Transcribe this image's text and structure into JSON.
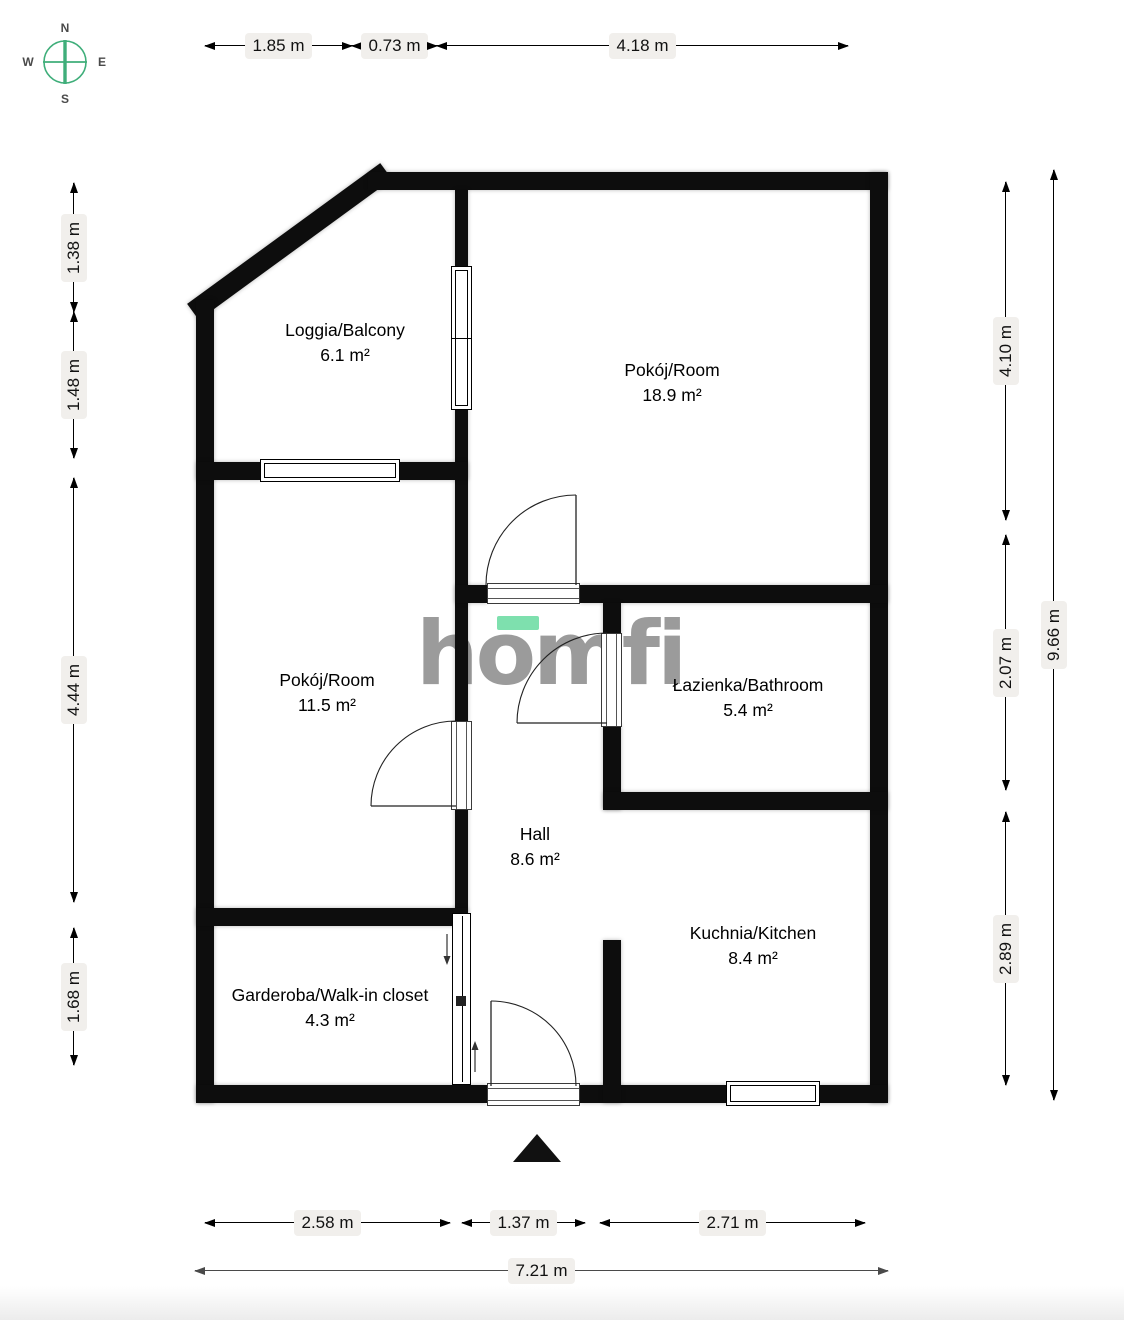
{
  "compass": {
    "north": "N",
    "east": "E",
    "south": "S",
    "west": "W"
  },
  "logo": {
    "text": "homfi"
  },
  "rooms": [
    {
      "name": "Loggia/Balcony",
      "area": "6.1 m²"
    },
    {
      "name": "Pokój/Room",
      "area": "18.9 m²"
    },
    {
      "name": "Pokój/Room",
      "area": "11.5 m²"
    },
    {
      "name": "Łazienka/Bathroom",
      "area": "5.4 m²"
    },
    {
      "name": "Hall",
      "area": "8.6 m²"
    },
    {
      "name": "Kuchnia/Kitchen",
      "area": "8.4 m²"
    },
    {
      "name": "Garderoba/Walk-in closet",
      "area": "4.3 m²"
    }
  ],
  "dimensions": {
    "top": [
      "1.85 m",
      "0.73 m",
      "4.18 m"
    ],
    "left": [
      "1.38 m",
      "1.48 m",
      "4.44 m",
      "1.68 m"
    ],
    "right": [
      "4.10 m",
      "2.07 m",
      "2.89 m"
    ],
    "right_total": "9.66 m",
    "bottom": [
      "2.58 m",
      "1.37 m",
      "2.71 m"
    ],
    "bottom_total": "7.21 m"
  },
  "colors": {
    "wall": "#0d0d0d",
    "logo_gray": "#9b9b9b",
    "logo_green": "#7ee0ae",
    "compass_green": "#3fae7a",
    "dim_label_bg": "#f1efec"
  }
}
